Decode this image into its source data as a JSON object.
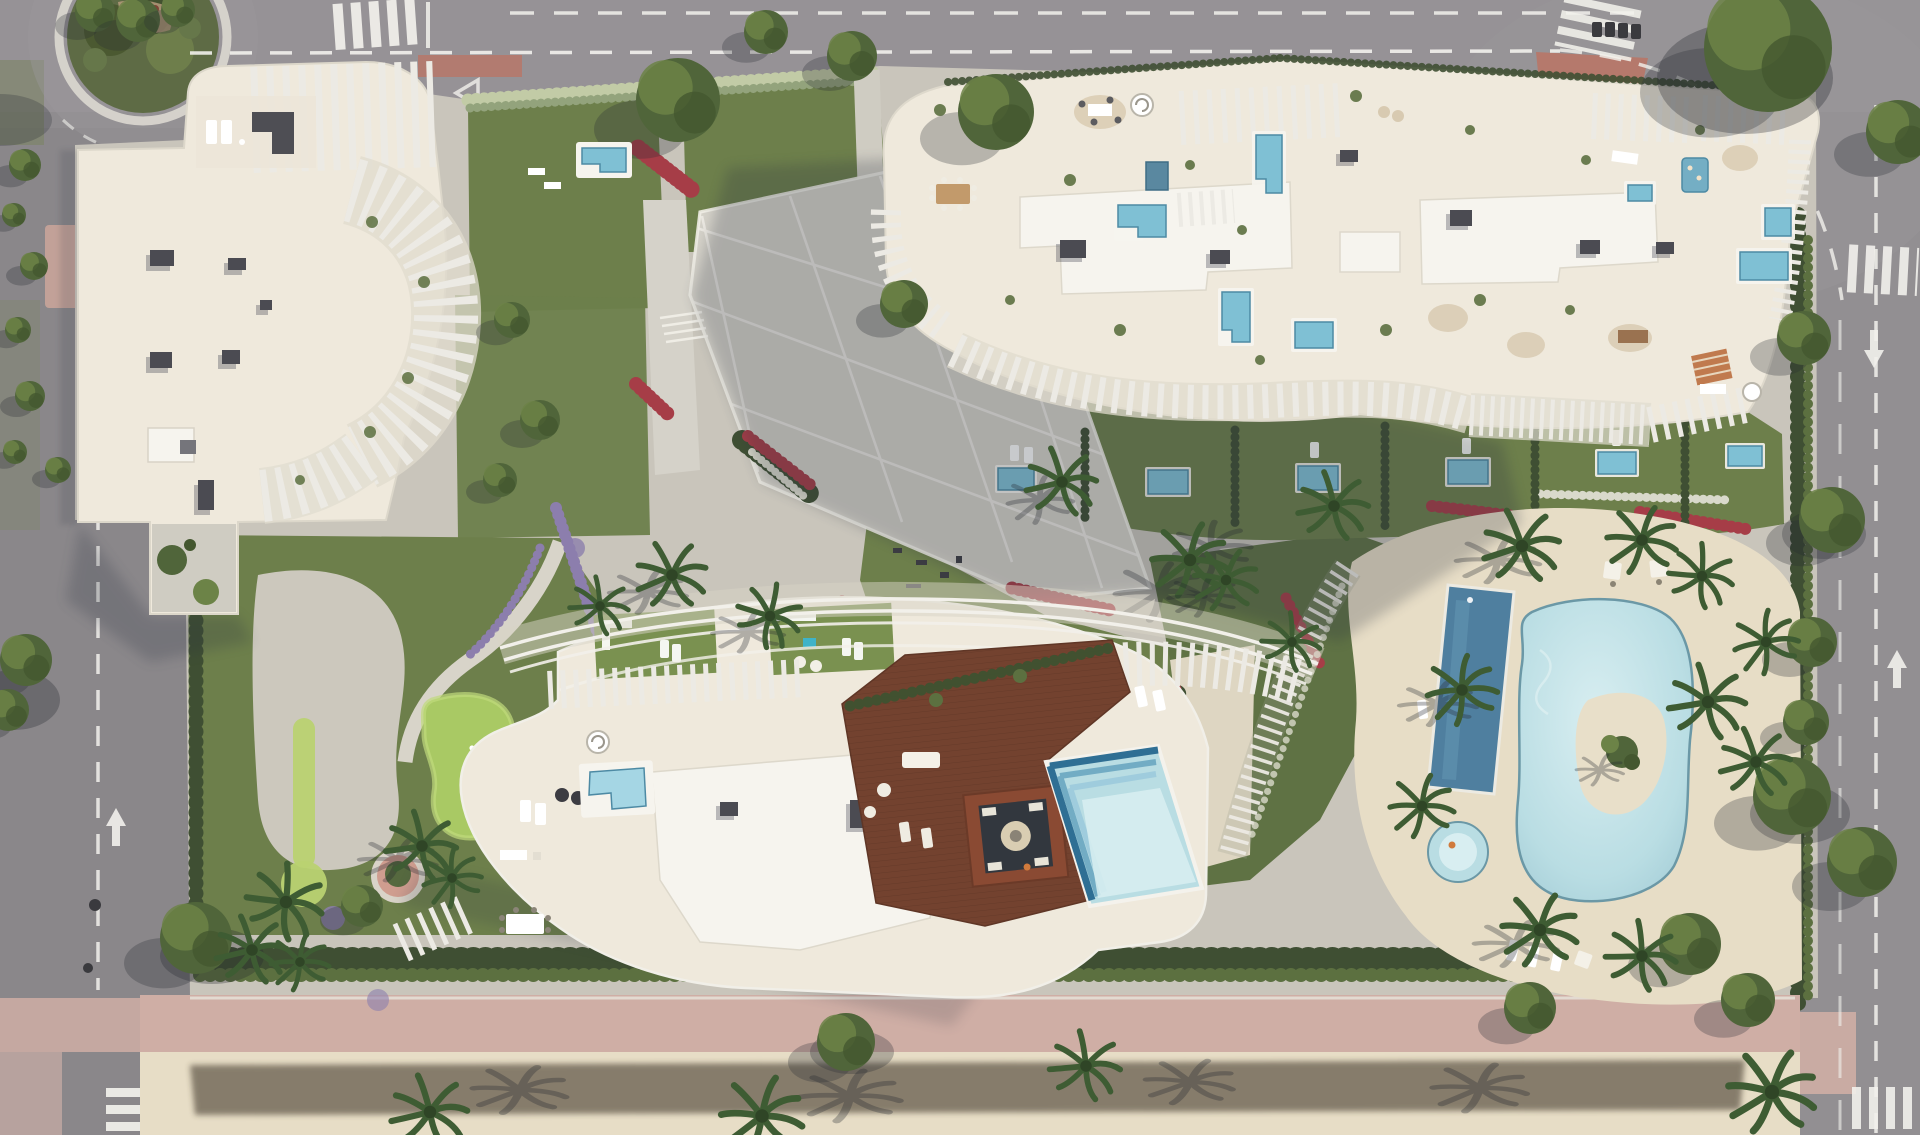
{
  "meta": {
    "title": "Aerial masterplan render of a white resort-style residential complex with lagoon pool, gardens and surrounding roads",
    "domain_note": "photorealistic architectural aerial render, no visible text",
    "visible_text": "none"
  },
  "palette": {
    "asphalt": "#8f8c8f",
    "asphaltLight": "#9c989c",
    "laneWhite": "#f2f1ec",
    "sidewalkPink": "#c2a198",
    "promenadePink": "#cfaea5",
    "redPaving": "#b5796c",
    "sand": "#e7ddc6",
    "sandPath": "#ded6c2",
    "siteBase": "#c9c5bb",
    "plaza": "#d5d2c9",
    "plazaLine": "#efede6",
    "lawn": "#6d7f4b",
    "lawnDark": "#5f7244",
    "lawnLight": "#819557",
    "roofLawn": "#7a9150",
    "putting": "#a9c964",
    "puttingLight": "#c0da7c",
    "hedge": "#3f4f33",
    "hedgeLight": "#5c7040",
    "whiteHedge": "#c2cba6",
    "treeGreen": "#50653a",
    "treeLight": "#6c8347",
    "palmGreen": "#3e5c33",
    "flowerRed": "#a63d47",
    "flowerRedDark": "#7e2a34",
    "flowerPurple": "#8c7ead",
    "flowerWhite": "#d9d9cb",
    "roofCream": "#efe9dc",
    "roofWhite": "#f6f4ee",
    "finWhite": "#eceae4",
    "terraceTone": "#e0dbce",
    "hvacDark": "#4b4b52",
    "hvacMid": "#75757b",
    "woodDeck": "#73422f",
    "woodLine": "#5a3222",
    "pitRim": "#8a4a33",
    "poolLagoon": "#b9dde3",
    "poolLagoonLight": "#d8eef1",
    "poolEdge": "#5d8d9e",
    "poolLap": "#4f7f9f",
    "poolPlunge": "#7fc0d4",
    "poolPlungeLight": "#a5d6e4",
    "poolStepDark": "#2f6f94",
    "poolStepMid": "#6aa6c0",
    "islandSand": "#e8dfc9",
    "shadowCool": "#2b3040",
    "shadowWarm": "#382f21",
    "orangeAccent": "#c07a4e",
    "figureOrange": "#d07a3c"
  },
  "scene": {
    "features": [
      {
        "name": "roundabout",
        "desc": "tree-filled traffic circle, top-left"
      },
      {
        "name": "building-west",
        "desc": "white tower with curved balcony fins and rooftop HVAC units"
      },
      {
        "name": "building-north-east",
        "desc": "large white slab with rooftop terraces and plunge pools"
      },
      {
        "name": "building-south",
        "desc": "white building with pergola arcs, wooden deck and rooftop pool"
      },
      {
        "name": "lagoon-pool",
        "desc": "organic lagoon pool with planted sand island"
      },
      {
        "name": "lap-pool",
        "desc": "dark blue rectangular lap pool"
      },
      {
        "name": "kids-pool",
        "desc": "small round pool"
      },
      {
        "name": "putting-green",
        "desc": "mini golf green in west garden"
      },
      {
        "name": "central-plaza",
        "desc": "pale paved boulevard with white grid joints"
      },
      {
        "name": "promenade",
        "desc": "pink and sand pedestrian strip along bottom edge with hedge shadow"
      },
      {
        "name": "roads",
        "desc": "asphalt roads on all sides with dashed lanes, arrows and zebra crossings"
      }
    ]
  }
}
